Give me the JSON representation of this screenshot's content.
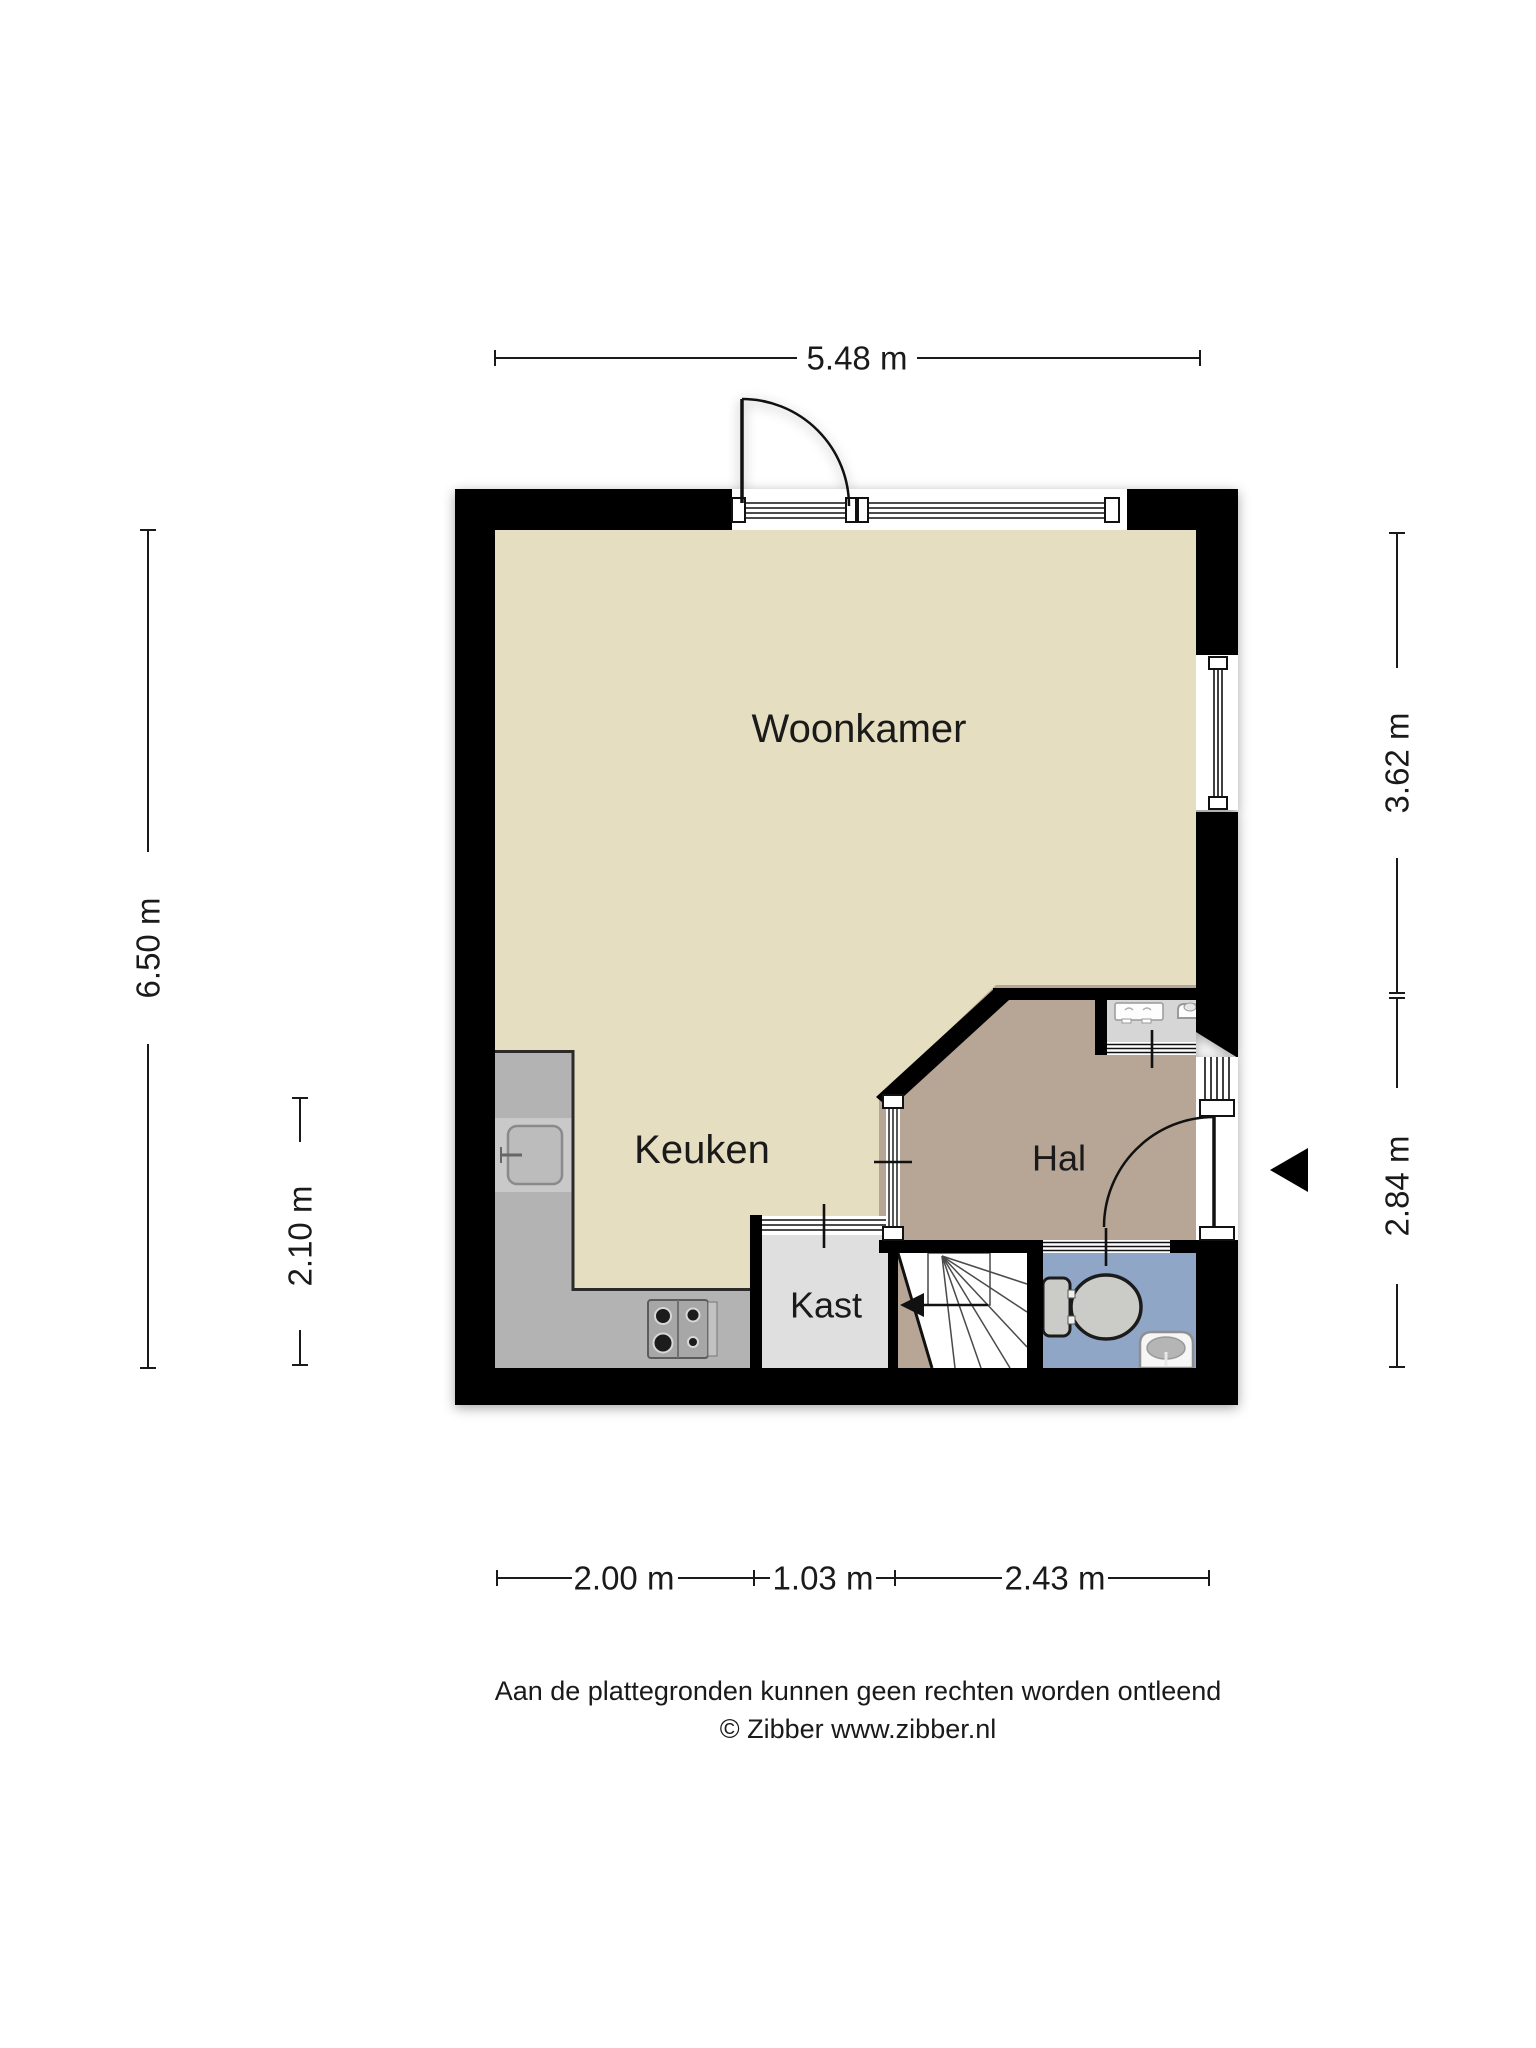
{
  "plan": {
    "rooms": {
      "woonkamer": {
        "label": "Woonkamer"
      },
      "keuken": {
        "label": "Keuken"
      },
      "hal": {
        "label": "Hal"
      },
      "kast": {
        "label": "Kast"
      }
    },
    "dimensions": {
      "top": {
        "label": "5.48 m"
      },
      "left_outer": {
        "label": "6.50 m"
      },
      "left_inner": {
        "label": "2.10 m"
      },
      "right_upper": {
        "label": "3.62 m"
      },
      "right_lower": {
        "label": "2.84 m"
      },
      "bottom_left": {
        "label": "2.00 m"
      },
      "bottom_middle": {
        "label": "1.03 m"
      },
      "bottom_right": {
        "label": "2.43 m"
      }
    },
    "icons": {
      "entrance_arrow": "left-pointing-entrance-arrow",
      "stairs": "winder-staircase-up-arrow",
      "toilet": "toilet-top-view",
      "hand_basin": "small-hand-basin",
      "kitchen_sink": "kitchen-sink-with-tap",
      "hob": "four-burner-hob",
      "utility_fixture": "utility-cabinet-fixture"
    }
  },
  "footer": {
    "disclaimer": "Aan de plattegronden kunnen geen rechten worden ontleend",
    "credit": "© Zibber www.zibber.nl"
  },
  "colors": {
    "wall": "#000000",
    "living_floor": "#e6dec1",
    "hal_floor": "#b7a695",
    "grayroom_floor": "#d6d6d6",
    "kast_floor": "#dfdfdf",
    "stairs_floor": "#ffffff",
    "toilet_floor": "#90a6c6",
    "counter": "#b3b3b3",
    "sink_band": "#c9c9c9",
    "fixture": "#cbcbc7"
  }
}
